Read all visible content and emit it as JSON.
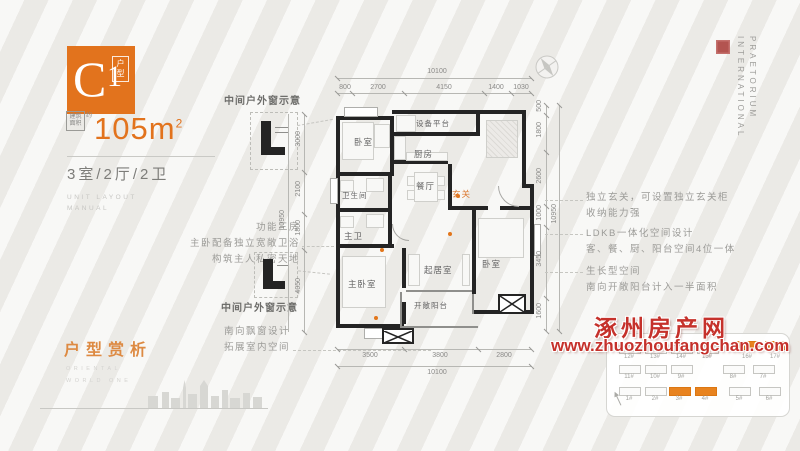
{
  "header": {
    "logo_letter": "C",
    "logo_number": "1",
    "logo_tag": "户型",
    "area_box": "建筑面积",
    "area_approx": "约",
    "area_value": "105",
    "area_unit": "m",
    "area_sup": "2",
    "spec": "3室/2厅/2卫",
    "sub1": "UNIT LAYOUT",
    "sub2": "MANUAL"
  },
  "annotations": {
    "left_feature": [
      "功能三房",
      "主卧配备独立宽敞卫浴",
      "构筑主人私密天地"
    ],
    "window_note_top": "中间户外窗示意",
    "window_note_bottom": "中间户外窗示意",
    "bay_note": [
      "南向飘窗设计",
      "拓展室内空间"
    ],
    "right_notes": [
      {
        "l1": "独立玄关，可设置独立玄关柜",
        "l2": "收纳能力强"
      },
      {
        "l1": "LDKB一体化空间设计",
        "l2": "客、餐、厨、阳台空间4位一体"
      },
      {
        "l1": "生长型空间",
        "l2": "南向开敞阳台计入一半面积"
      }
    ]
  },
  "plan": {
    "rooms": {
      "bedroom_top": "卧室",
      "equipment": "设备平台",
      "kitchen": "厨房",
      "dining": "餐厅",
      "entry": "玄关",
      "bath": "卫生间",
      "master_bath": "主卫",
      "master_bedroom": "主卧室",
      "living": "起居室",
      "balcony": "开敞阳台",
      "bedroom_right": "卧室"
    }
  },
  "dimensions": {
    "top": {
      "overall": "10100",
      "segments": [
        "800",
        "2700",
        "4150",
        "1400",
        "1030"
      ]
    },
    "bottom": {
      "overall": "10100",
      "segments": [
        "3500",
        "3800",
        "2800"
      ]
    },
    "right": {
      "overall": "10950",
      "segments": [
        "500",
        "1800",
        "2600",
        "1000",
        "3450",
        "1600"
      ]
    },
    "left": {
      "overall": "10950",
      "segments": [
        "3000",
        "2100",
        "1800",
        "4050"
      ]
    }
  },
  "section": {
    "title": "户型赏析",
    "en1": "ORIENTAL",
    "en2": "WORLD ONE"
  },
  "brand": {
    "word1": "PRAETORIUM",
    "word2": "INTERNATIONAL"
  },
  "watermark": {
    "name": "涿州房产网",
    "url": "www.zhuozhoufangchan.com"
  },
  "site": {
    "rows": [
      {
        "buildings": [
          {
            "label": "12#",
            "hl": false
          },
          {
            "label": "13#",
            "hl": false
          },
          {
            "label": "14#",
            "hl": false
          },
          {
            "label": "15#",
            "hl": false
          },
          {
            "label": "16#",
            "hl": true
          },
          {
            "label": "17#",
            "hl": true
          }
        ]
      },
      {
        "buildings": [
          {
            "label": "11#",
            "hl": false
          },
          {
            "label": "10#",
            "hl": false
          },
          {
            "label": "9#",
            "hl": false
          },
          {
            "label": "8#",
            "hl": false
          },
          {
            "label": "7#",
            "hl": false
          }
        ]
      },
      {
        "buildings": [
          {
            "label": "1#",
            "hl": false
          },
          {
            "label": "2#",
            "hl": false
          },
          {
            "label": "3#",
            "hl": true
          },
          {
            "label": "4#",
            "hl": true
          },
          {
            "label": "5#",
            "hl": false
          },
          {
            "label": "6#",
            "hl": false
          }
        ]
      }
    ]
  },
  "colors": {
    "accent": "#e2761b",
    "watermark_red": "#c5312b",
    "wall": "#242424"
  }
}
